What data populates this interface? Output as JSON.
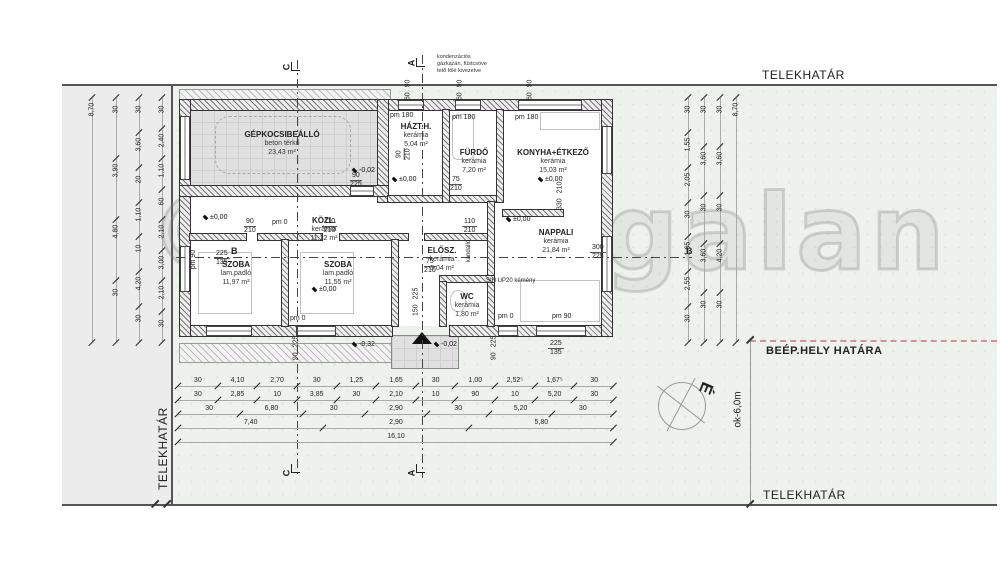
{
  "site": {
    "telekhatar_top": "TELEKHATÁR",
    "telekhatar_bottom": "TELEKHATÁR",
    "telekhatar_left": "TELEKHATÁR",
    "beep_hely_hatara": "BEÉP.HELY HATÁRA",
    "ok_6m": "ok-6,0m",
    "north_letter": "É"
  },
  "watermark": "©sargagalan",
  "boiler_note": {
    "line1": "kondenzációs",
    "line2": "gázkazán, füstcsöve",
    "line3": "tető fölé kivezetve"
  },
  "sections": {
    "a": "A",
    "b": "B",
    "c": "C"
  },
  "rooms": {
    "garage": {
      "name": "GÉPKOCSIBEÁLLÓ",
      "floor": "beton térkő",
      "area": "23,43 m²"
    },
    "hazth": {
      "name": "HÁZT.H.",
      "floor": "kerámia",
      "area": "5,04 m²"
    },
    "furdo": {
      "name": "FÜRDŐ",
      "floor": "kerámia",
      "area": "7,20 m²"
    },
    "konyha": {
      "name": "KONYHA+ÉTKEZŐ",
      "floor": "kerámia",
      "area": "15,03 m²"
    },
    "kozl": {
      "name": "KÖZL.",
      "floor": "kerámia",
      "area": "11,12 m²"
    },
    "szoba1": {
      "name": "SZOBA",
      "floor": "lam.padló",
      "area": "11,97 m²"
    },
    "szoba2": {
      "name": "SZOBA",
      "floor": "lam.padló",
      "area": "11,55 m²"
    },
    "elosz": {
      "name": "ELŐSZ.",
      "floor": "kerámia",
      "area": "5,04 m²"
    },
    "wc": {
      "name": "WC",
      "floor": "kerámia",
      "area": "1,80 m²"
    },
    "nappali": {
      "name": "NAPPALI",
      "floor": "kerámia",
      "area": "21,84 m²"
    }
  },
  "labels": {
    "pm180": "pm 180",
    "pm0": "pm 0",
    "pm90": "pm 90",
    "kandallo": "kandalló",
    "kemeny": "SIH UP20 kémény"
  },
  "levels": {
    "zero": "±0,00",
    "minus02": "-0,02",
    "minus32": "-0,32"
  },
  "openings": {
    "garage_exit": {
      "w": "90",
      "h": "225"
    },
    "door_hazth": {
      "w": "90",
      "h": "210"
    },
    "door_szoba1": {
      "w": "90",
      "h": "210"
    },
    "door_kozl1": {
      "w": "110",
      "h": "210"
    },
    "door_kozl2": {
      "w": "110",
      "h": "210"
    },
    "door_furdo": {
      "w": "75",
      "h": "210"
    },
    "door_wc": {
      "w": "75",
      "h": "210"
    },
    "win_kitchen": {
      "w": "330",
      "h": "210"
    },
    "win_east": {
      "w": "300",
      "h": "225"
    },
    "win_west": {
      "w": "225",
      "h": "135"
    },
    "door_entry": {
      "w": "150",
      "h": "225"
    },
    "win_s_szoba2": {
      "w": "90",
      "h": "225"
    },
    "win_s_nappali1": {
      "w": "90",
      "h": "225"
    },
    "win_s_nappali2": {
      "w": "225",
      "h": "135"
    },
    "win_top1": {
      "w": "60",
      "h": "90"
    },
    "win_top2": {
      "w": "60",
      "h": "90"
    },
    "win_top3": {
      "w": "60",
      "h": "90"
    }
  },
  "dims": {
    "left1": [
      "8,70"
    ],
    "left2": [
      "30",
      "3,90",
      "4,80",
      "30"
    ],
    "left3": [
      "30",
      "3,60",
      "20",
      "1,10",
      "10",
      "4,20",
      "30"
    ],
    "left4": [
      "30",
      "2,40",
      "1,10",
      "60",
      "2,10",
      "3,00",
      "2,10",
      "30"
    ],
    "right1": [
      "30",
      "1,55",
      "2,05",
      "30",
      "1,65",
      "2,55",
      "30"
    ],
    "right2": [
      "30",
      "3,60",
      "30",
      "3,60",
      "30"
    ],
    "right3": [
      "30",
      "3,60",
      "30",
      "4,20",
      "30"
    ],
    "right4": [
      "8,70"
    ],
    "bottom1": [
      "30",
      "4,10",
      "2,70",
      "30",
      "1,25",
      "1,65",
      "30",
      "1,00",
      "2,52⁵",
      "1,67⁵",
      "30"
    ],
    "bottom2": [
      "30",
      "2,85",
      "10",
      "3,85",
      "30",
      "2,10",
      "10",
      "90",
      "10",
      "5,20",
      "30"
    ],
    "bottom3": [
      "30",
      "6,80",
      "30",
      "2,90",
      "30",
      "5,20",
      "30"
    ],
    "bottom4": [
      "7,40",
      "2,90",
      "5,80"
    ],
    "bottom5": [
      "16,10"
    ]
  }
}
